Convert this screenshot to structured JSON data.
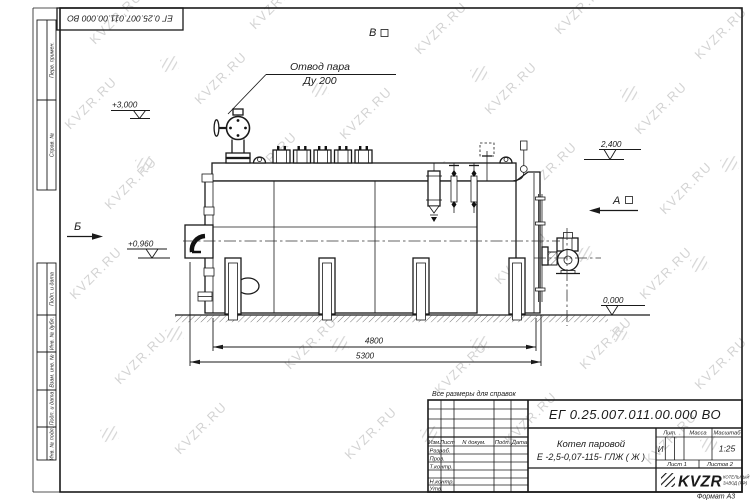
{
  "watermark": {
    "text": "KVZR.RU"
  },
  "corner_stamp": {
    "doc_number": "ЕГ 0.25.007.011.00.000  ВО"
  },
  "margin_labels": {
    "perv": "Перв. примен.",
    "sprav": "Справ. №",
    "podp1": "Подп. и дата",
    "inv_dubl": "Инв. № дубл.",
    "vzam": "Взам. инв. №",
    "podp2": "Подп. и дата",
    "inv_podl": "Инв. № подл."
  },
  "note": "Все размеры для справок",
  "annotations": {
    "steam_line1": "Отвод пара",
    "steam_line2": "Ду 200",
    "level_3000": "+3,000",
    "level_2400": "2,400",
    "level_0960": "+0,960",
    "level_0000": "0,000",
    "dim_4800": "4800",
    "dim_5300": "5300",
    "view_a": "А",
    "view_b": "Б",
    "view_v": "В"
  },
  "title_block": {
    "doc_number": "ЕГ 0.25.007.011.00.000  ВО",
    "name_line1": "Котел паровой",
    "name_line2": "Е -2,5-0,07-115- ГЛЖ ( Ж )",
    "col_izm": "Изм.",
    "col_list": "Лист",
    "col_ndoc": "N докум.",
    "col_podp": "Подп.",
    "col_data": "Дата",
    "row_razrab": "Разраб.",
    "row_prov": "Пров.",
    "row_tkontr": "Т.контр.",
    "row_nkontr": "Н.контр.",
    "row_utv": "Утв.",
    "lit_header": "Лит.",
    "mass_header": "Масса",
    "scale_header": "Масштаб",
    "lit_value": "И",
    "scale_value": "1:25",
    "sheet": "Лист 1",
    "sheets": "Листов 2",
    "company_logo": "KVZR",
    "company_line1": "КОТЕЛЬНЫЙ",
    "company_line2": "ЗАВОД (РФ)",
    "format": "Формат А3"
  }
}
